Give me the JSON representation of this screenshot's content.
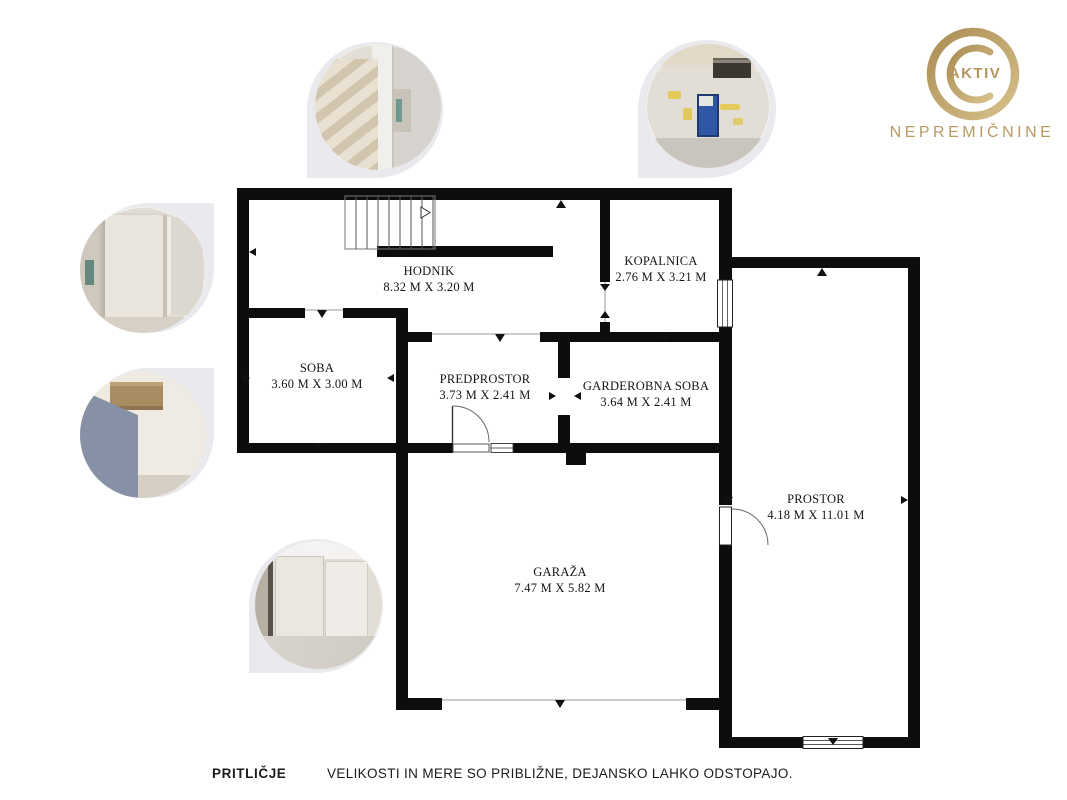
{
  "colors": {
    "wall": "#0d0d0d",
    "gold": "#b89a63",
    "photo_backing": "#e9e9ee"
  },
  "logo": {
    "badge": "AKTIV",
    "brand": "NEPREMIČNINE"
  },
  "rooms": {
    "hodnik": {
      "name": "HODNIK",
      "dims": "8.32 M X 3.20 M"
    },
    "kopalnica": {
      "name": "KOPALNICA",
      "dims": "2.76 M X 3.21 M"
    },
    "soba": {
      "name": "SOBA",
      "dims": "3.60 M X 3.00 M"
    },
    "predprostor": {
      "name": "PREDPROSTOR",
      "dims": "3.73 M X 2.41 M"
    },
    "garderobna": {
      "name": "GARDEROBNA SOBA",
      "dims": "3.64 M X 2.41 M"
    },
    "prostor": {
      "name": "PROSTOR",
      "dims": "4.18 M X 11.01 M"
    },
    "garaza": {
      "name": "GARAŽA",
      "dims": "7.47 M X 5.82 M"
    }
  },
  "footer": {
    "floor_name": "PRITLIČJE",
    "disclaimer": "VELIKOSTI IN MERE SO PRIBLIŽNE, DEJANSKO LAHKO ODSTOPAJO."
  },
  "photos": [
    {
      "id": "stairwell-photo"
    },
    {
      "id": "bathroom-roughin-photo"
    },
    {
      "id": "room-drywall-photo"
    },
    {
      "id": "room-grey-board-photo"
    },
    {
      "id": "garage-interior-photo"
    }
  ]
}
